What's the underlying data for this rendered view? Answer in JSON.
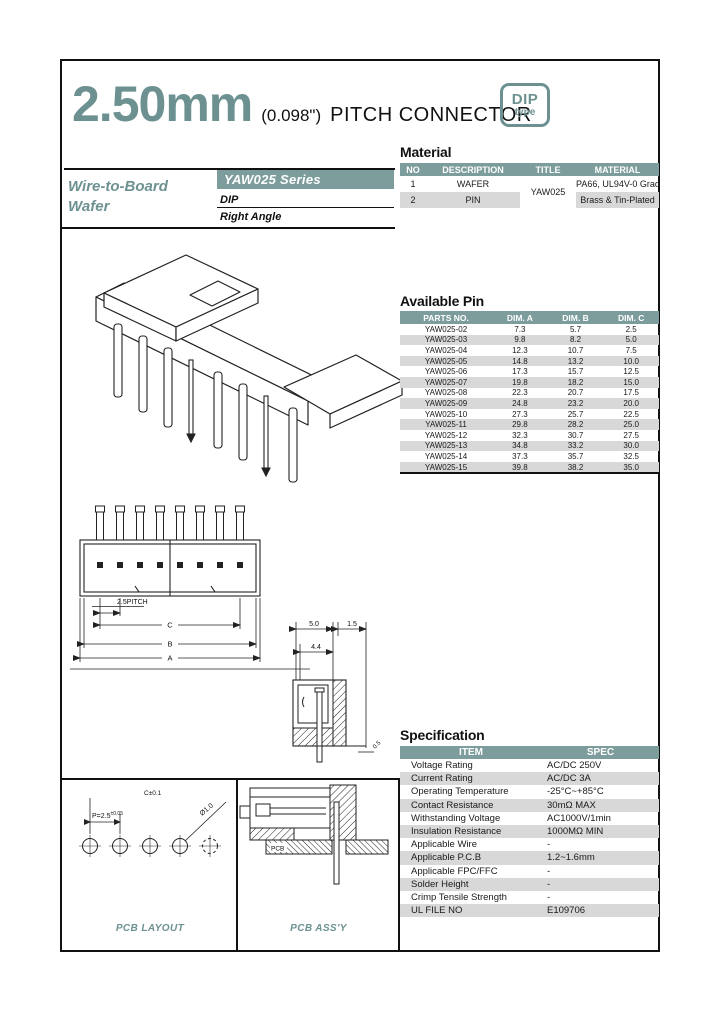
{
  "header": {
    "title_mm": "2.50mm",
    "title_inch": "(0.098\")",
    "title_rest": "PITCH CONNECTOR",
    "badge_line1": "DIP",
    "badge_line2": "type"
  },
  "series": {
    "family_line1": "Wire-to-Board",
    "family_line2": "Wafer",
    "name": "YAW025 Series",
    "mount_type": "DIP",
    "orientation": "Right Angle"
  },
  "material": {
    "title": "Material",
    "headers": [
      "NO",
      "DESCRIPTION",
      "TITLE",
      "MATERIAL"
    ],
    "title_value": "YAW025",
    "rows": [
      {
        "no": "1",
        "desc": "WAFER",
        "material": "PA66, UL94V-0 Grade"
      },
      {
        "no": "2",
        "desc": "PIN",
        "material": "Brass & Tin-Plated"
      }
    ]
  },
  "available_pin": {
    "title": "Available Pin",
    "headers": [
      "PARTS NO.",
      "DIM. A",
      "DIM. B",
      "DIM. C"
    ],
    "rows": [
      [
        "YAW025-02",
        "7.3",
        "5.7",
        "2.5"
      ],
      [
        "YAW025-03",
        "9.8",
        "8.2",
        "5.0"
      ],
      [
        "YAW025-04",
        "12.3",
        "10.7",
        "7.5"
      ],
      [
        "YAW025-05",
        "14.8",
        "13.2",
        "10.0"
      ],
      [
        "YAW025-06",
        "17.3",
        "15.7",
        "12.5"
      ],
      [
        "YAW025-07",
        "19.8",
        "18.2",
        "15.0"
      ],
      [
        "YAW025-08",
        "22.3",
        "20.7",
        "17.5"
      ],
      [
        "YAW025-09",
        "24.8",
        "23.2",
        "20.0"
      ],
      [
        "YAW025-10",
        "27.3",
        "25.7",
        "22.5"
      ],
      [
        "YAW025-11",
        "29.8",
        "28.2",
        "25.0"
      ],
      [
        "YAW025-12",
        "32.3",
        "30.7",
        "27.5"
      ],
      [
        "YAW025-13",
        "34.8",
        "33.2",
        "30.0"
      ],
      [
        "YAW025-14",
        "37.3",
        "35.7",
        "32.5"
      ],
      [
        "YAW025-15",
        "39.8",
        "38.2",
        "35.0"
      ]
    ]
  },
  "specification": {
    "title": "Specification",
    "headers": [
      "ITEM",
      "SPEC"
    ],
    "rows": [
      [
        "Voltage Rating",
        "AC/DC 250V"
      ],
      [
        "Current Rating",
        "AC/DC 3A"
      ],
      [
        "Operating Temperature",
        "-25°C~+85°C"
      ],
      [
        "Contact Resistance",
        "30mΩ MAX"
      ],
      [
        "Withstanding Voltage",
        "AC1000V/1min"
      ],
      [
        "Insulation Resistance",
        "1000MΩ MIN"
      ],
      [
        "Applicable Wire",
        "-"
      ],
      [
        "Applicable P.C.B",
        "1.2~1.6mm"
      ],
      [
        "Applicable FPC/FFC",
        "-"
      ],
      [
        "Solder Height",
        "-"
      ],
      [
        "Crimp Tensile Strength",
        "-"
      ],
      [
        "UL FILE NO",
        "E109706"
      ]
    ]
  },
  "drawings": {
    "front_view": {
      "pitch": "2.5PITCH",
      "dim_c": "C",
      "dim_b": "B",
      "dim_a": "A"
    },
    "side_view": {
      "d_top1": "5.0",
      "d_top2": "1.5",
      "d_inner": "4.4",
      "d_standoff": "0.5"
    },
    "pcb_layout": {
      "caption": "PCB LAYOUT",
      "row_tol": "C±0.1",
      "pitch": "P=2.5",
      "pitch_tol": "±0.05",
      "hole_dia": "Ø1.0"
    },
    "pcb_assy": {
      "caption": "PCB ASS'Y",
      "board_label": "PCB"
    }
  },
  "colors": {
    "accent_teal": "#6d9191",
    "table_header_bg": "#7d9c9c",
    "row_alt_bg": "#d8d8d8"
  }
}
